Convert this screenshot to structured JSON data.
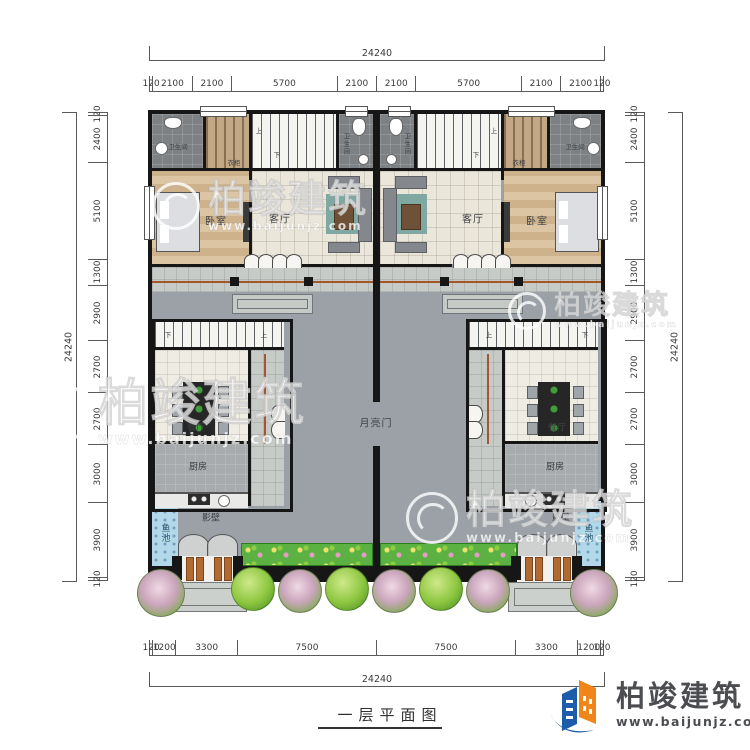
{
  "title": {
    "drawing_title": "一层平面图"
  },
  "brand": {
    "name": "柏竣建筑",
    "url": "www.baijunjz.com"
  },
  "dimensions": {
    "top": {
      "total": "24240",
      "segments": [
        120,
        2100,
        2100,
        5700,
        2100,
        2100,
        5700,
        2100,
        2100,
        120
      ]
    },
    "bottom": {
      "total": "24240",
      "segments": [
        120,
        1200,
        3300,
        7500,
        7500,
        3300,
        1200,
        120
      ]
    },
    "left": {
      "total": "24240",
      "segments": [
        120,
        2400,
        5100,
        1300,
        2900,
        2700,
        2700,
        3000,
        3900,
        120
      ]
    },
    "right": {
      "total": "24240",
      "segments": [
        120,
        2400,
        5100,
        1300,
        2900,
        2700,
        2700,
        3000,
        3900,
        120
      ]
    }
  },
  "rooms": {
    "bedroom": "卧室",
    "living_room": "客厅",
    "bathroom": "卫生间",
    "wardrobe": "衣柜",
    "dining_room": "餐厅",
    "kitchen": "厨房",
    "screen_wall": "影壁",
    "fish_pond": "鱼池",
    "moon_gate": "月亮门"
  },
  "stairs": {
    "up": "上",
    "down": "下"
  }
}
